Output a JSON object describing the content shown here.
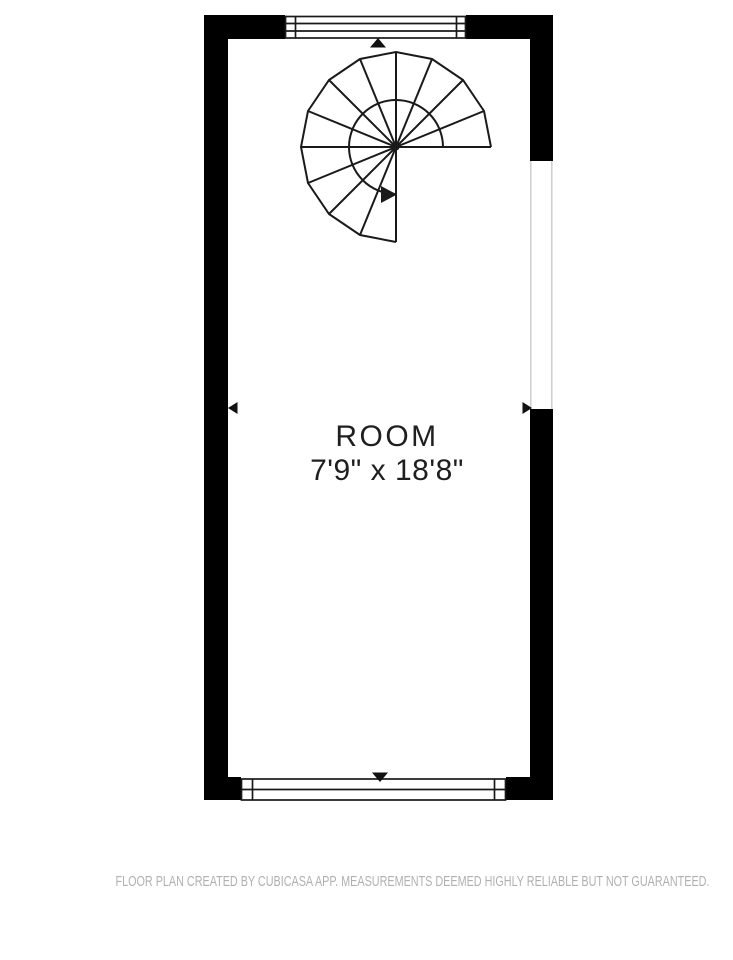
{
  "canvas": {
    "width": 733,
    "height": 960,
    "background": "#ffffff"
  },
  "floor_plan": {
    "room": {
      "name": "ROOM",
      "dimensions": "7'9\" x 18'8\""
    },
    "features": {
      "staircase": "spiral-staircase",
      "windows": [
        "top-wall-window",
        "bottom-wall-window"
      ],
      "opening": "right-wall-opening",
      "dimension_markers": [
        "up-arrow",
        "down-arrow",
        "left-arrow",
        "right-arrow"
      ]
    },
    "colors": {
      "wall": "#000000",
      "stair_line": "#1a1a1a",
      "opening_line": "#cdcdcd",
      "label_text": "#1f1f1f",
      "footer_text": "#b0b0b0"
    }
  },
  "footer": {
    "disclaimer": "FLOOR PLAN CREATED BY CUBICASA APP. MEASUREMENTS DEEMED HIGHLY RELIABLE BUT NOT GUARANTEED."
  }
}
